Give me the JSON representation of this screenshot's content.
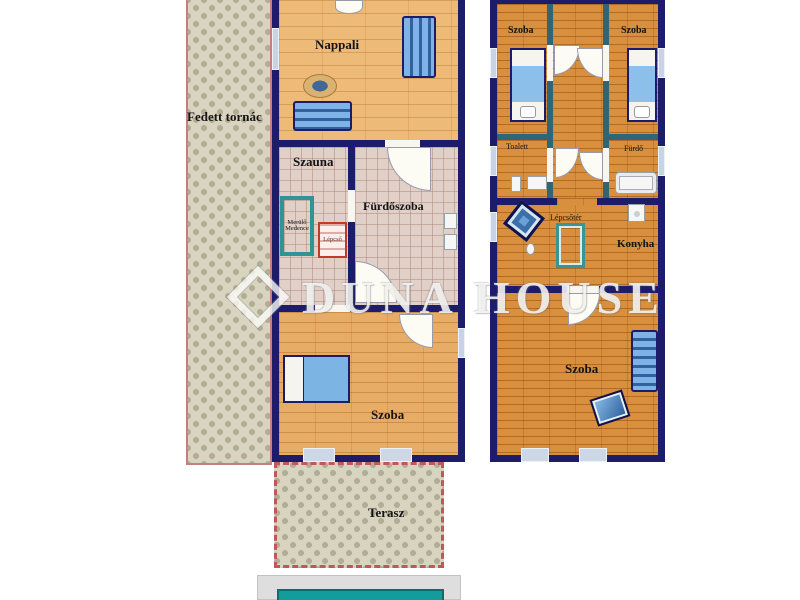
{
  "watermark": {
    "brand": "DUNA HOUSE"
  },
  "plans": {
    "ground": {
      "porch": "Fedett tornác",
      "living_room": "Nappali",
      "sauna": "Szauna",
      "plunge_pool": {
        "line1": "Merülő",
        "line2": "Medence"
      },
      "stairs": "Lépcső",
      "bathroom": "Fürdőszoba",
      "bedroom": "Szoba",
      "terrace": "Terasz"
    },
    "upper": {
      "bedroom_left": "Szoba",
      "bedroom_right": "Szoba",
      "toilet": "Toalett",
      "bath": "Fürdő",
      "stairwell": "Lépcsőtér",
      "kitchen": "Konyha",
      "bedroom_bottom": "Szoba"
    }
  },
  "colors": {
    "outer_wall": "#1c1c6b",
    "partition_wall": "#2e6678",
    "wood_light": "#edba78",
    "wood_dark": "#d8903f",
    "ornamental_tile_base": "#d8d4c0",
    "ornamental_tile_motif": "#b2ae96",
    "bath_tile": "#e0d0c8",
    "accent_teal": "#2f9494",
    "accent_red": "#c43a2a",
    "furniture_blue": "#6aa0d8",
    "pool_water": "#129c9c",
    "terrace_border": "#c05858"
  }
}
